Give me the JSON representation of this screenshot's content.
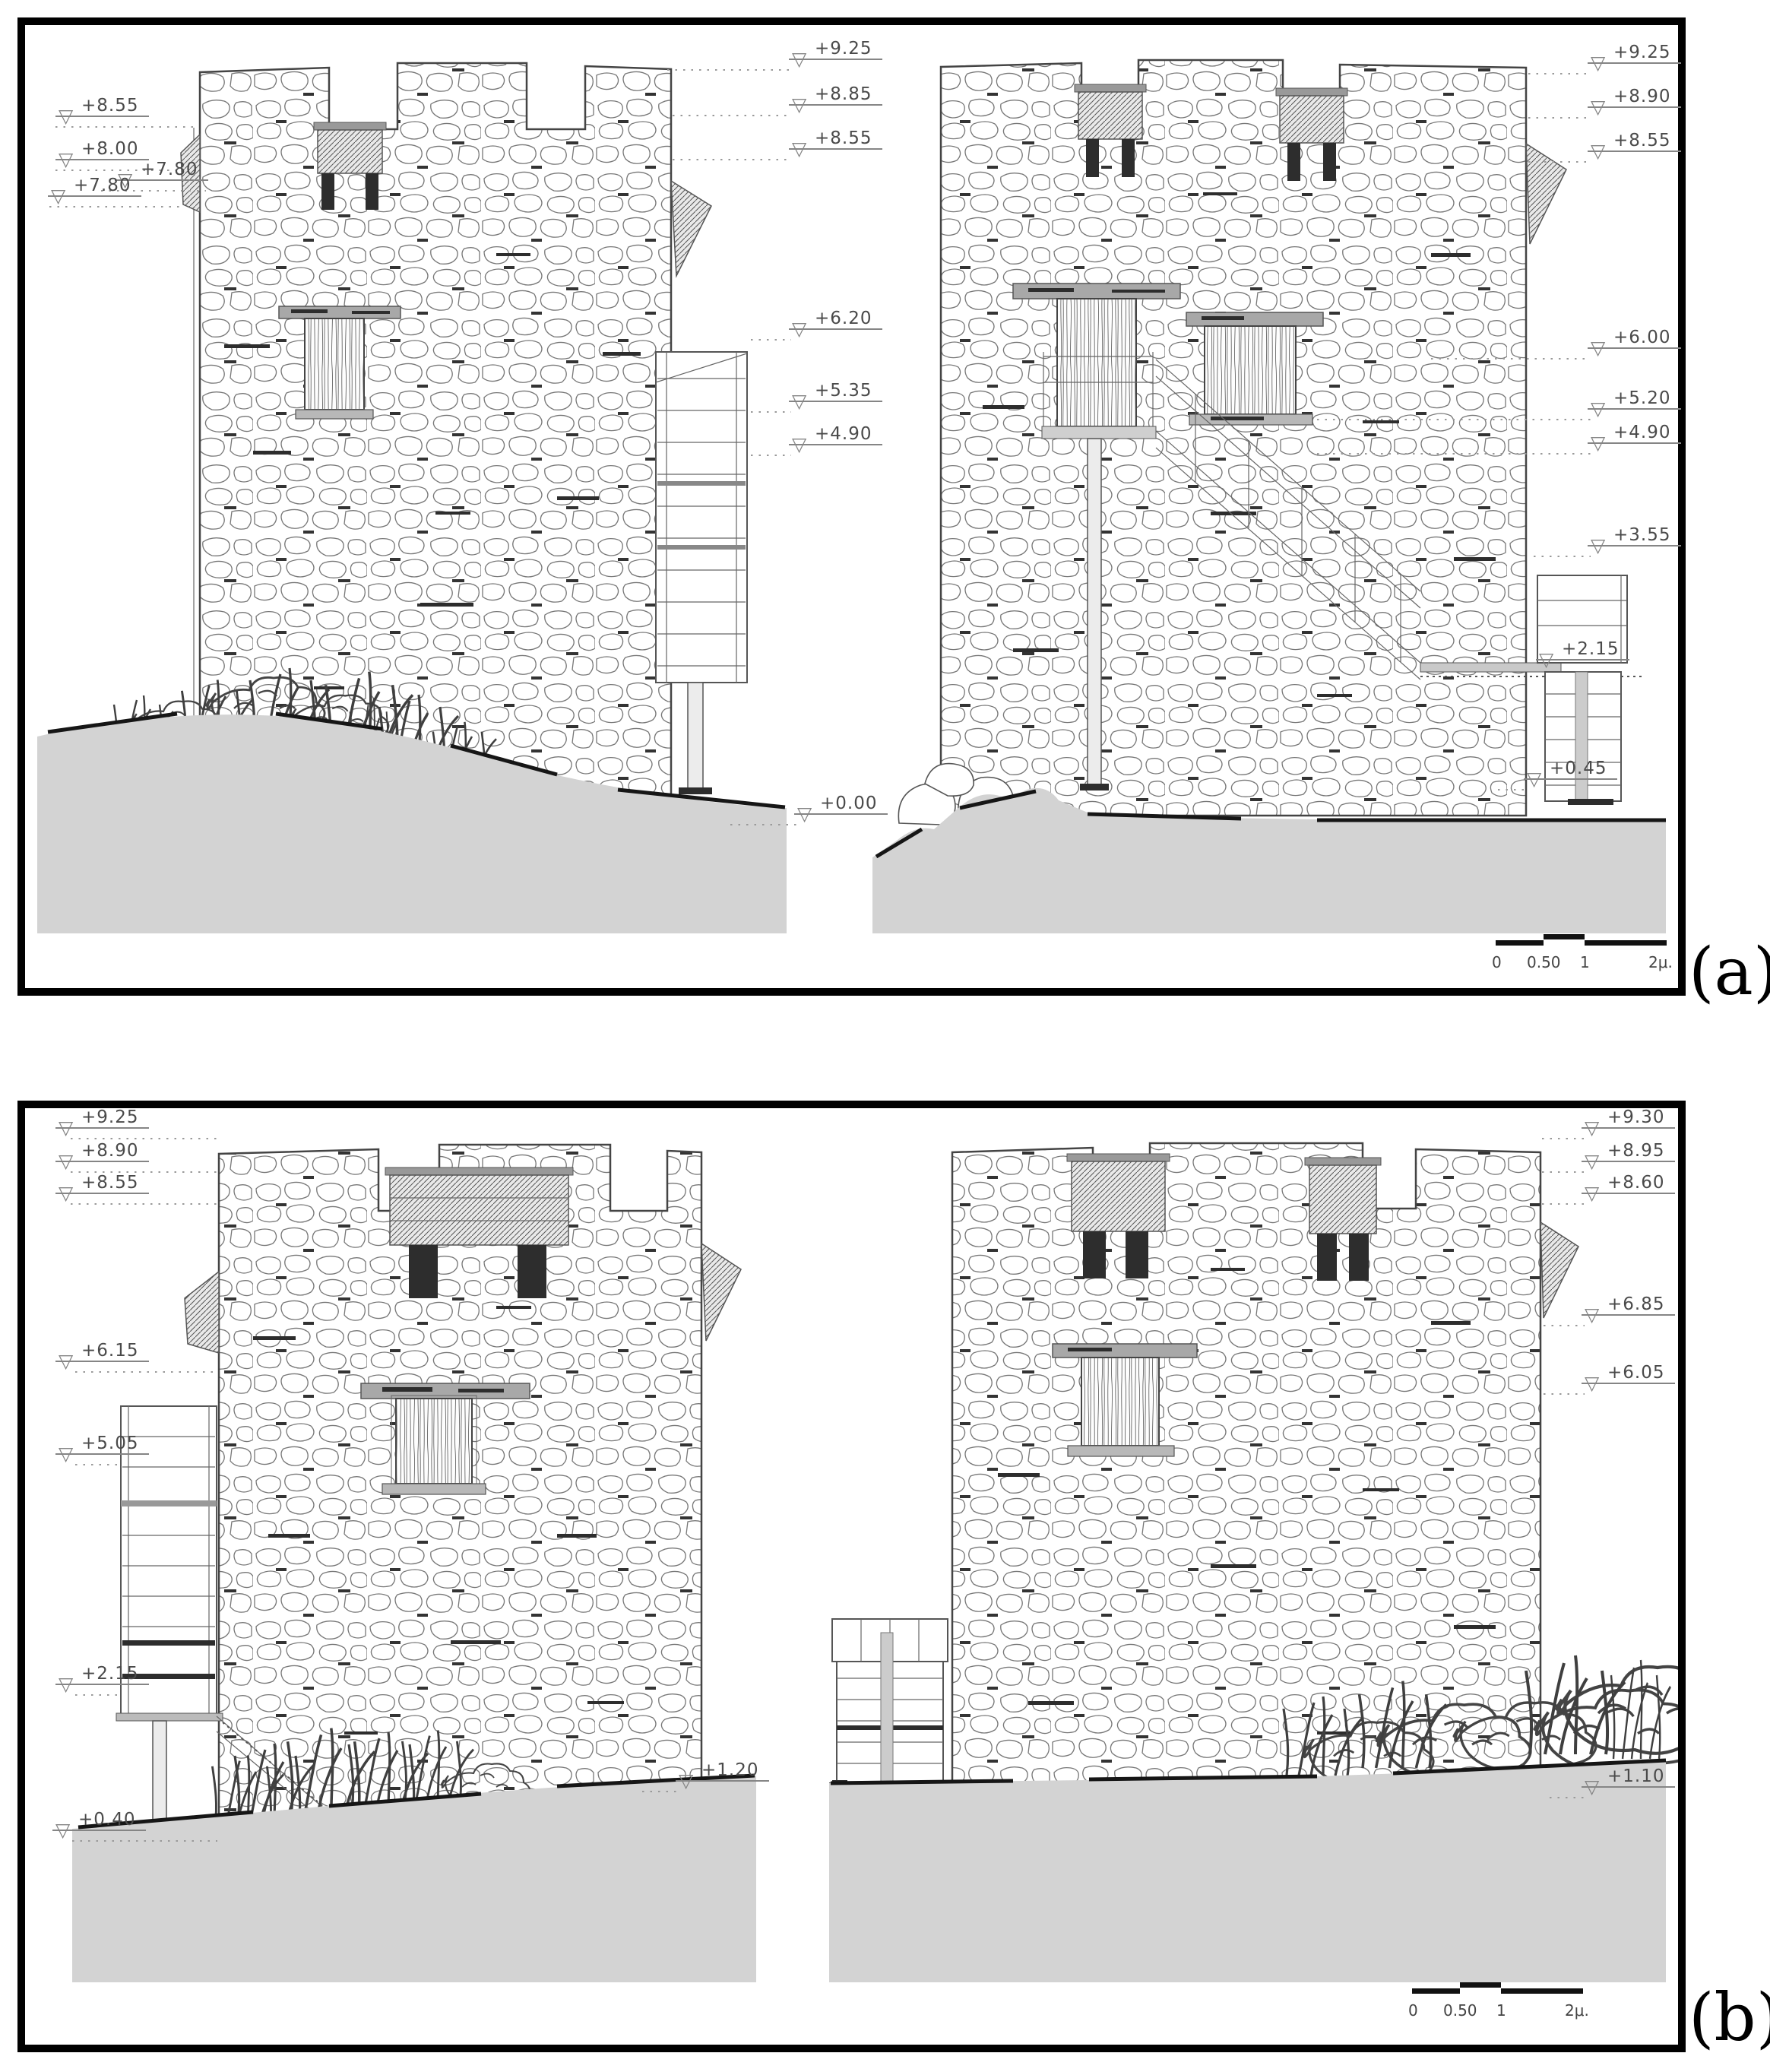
{
  "panel_a": {
    "caption": "(a)",
    "markers": [
      {
        "label": "+8.55"
      },
      {
        "label": "+8.00"
      },
      {
        "label": "+7.80"
      },
      {
        "label": "+7.80"
      },
      {
        "label": "+9.25"
      },
      {
        "label": "+8.85"
      },
      {
        "label": "+8.55"
      },
      {
        "label": "+6.20"
      },
      {
        "label": "+5.35"
      },
      {
        "label": "+4.90"
      },
      {
        "label": "+0.00"
      },
      {
        "label": "+9.25"
      },
      {
        "label": "+8.90"
      },
      {
        "label": "+8.55"
      },
      {
        "label": "+6.00"
      },
      {
        "label": "+5.20"
      },
      {
        "label": "+4.90"
      },
      {
        "label": "+3.55"
      },
      {
        "label": "+2.15"
      },
      {
        "label": "+0.45"
      }
    ],
    "scale_bar": {
      "ticks": [
        "0",
        "0.50",
        "1",
        "2μ."
      ]
    }
  },
  "panel_b": {
    "caption": "(b)",
    "markers": [
      {
        "label": "+9.25"
      },
      {
        "label": "+8.90"
      },
      {
        "label": "+8.55"
      },
      {
        "label": "+6.15"
      },
      {
        "label": "+5.05"
      },
      {
        "label": "+2.15"
      },
      {
        "label": "+0.40"
      },
      {
        "label": "+1.20"
      },
      {
        "label": "+9.30"
      },
      {
        "label": "+8.95"
      },
      {
        "label": "+8.60"
      },
      {
        "label": "+6.85"
      },
      {
        "label": "+6.05"
      },
      {
        "label": "+1.10"
      }
    ],
    "scale_bar": {
      "ticks": [
        "0",
        "0.50",
        "1",
        "2μ."
      ]
    }
  }
}
